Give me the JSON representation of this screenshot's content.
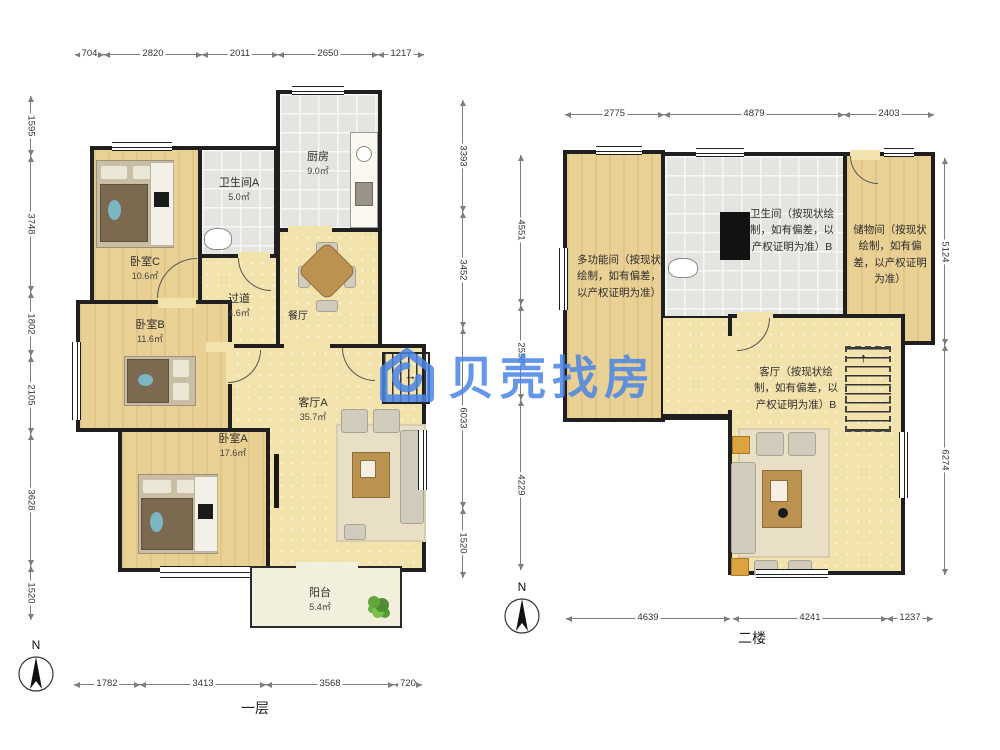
{
  "watermark": {
    "brand": "贝壳找房",
    "color": "#4a85e6"
  },
  "floor1": {
    "label": "一层",
    "compass": "N",
    "rooms": {
      "kitchen": {
        "name": "厨房",
        "area": "9.0㎡"
      },
      "bathA": {
        "name": "卫生间A",
        "area": "5.0㎡"
      },
      "bedC": {
        "name": "卧室C",
        "area": "10.6㎡"
      },
      "hall": {
        "name": "过道",
        "area": "4.6㎡"
      },
      "dining": {
        "name": "餐厅",
        "area": ""
      },
      "bedB": {
        "name": "卧室B",
        "area": "11.6㎡"
      },
      "livingA": {
        "name": "客厅A",
        "area": "35.7㎡"
      },
      "bedA": {
        "name": "卧室A",
        "area": "17.6㎡"
      },
      "balcony": {
        "name": "阳台",
        "area": "5.4㎡"
      }
    },
    "dims": {
      "top": [
        "704",
        "2820",
        "2011",
        "2650",
        "1217"
      ],
      "left": [
        "1595",
        "3748",
        "1802",
        "2105",
        "3628",
        "1520"
      ],
      "right": [
        "3393",
        "3452",
        "6033",
        "1520"
      ],
      "bottom": [
        "1782",
        "3413",
        "3568",
        "720"
      ]
    }
  },
  "floor2": {
    "label": "二楼",
    "compass": "N",
    "rooms": {
      "multi": {
        "name": "多功能间（按现状绘制，如有偏差，以产权证明为准）"
      },
      "bathB": {
        "name": "卫生间（按现状绘制，如有偏差，以产权证明为准）B"
      },
      "storage": {
        "name": "储物间（按现状绘制，如有偏差，以产权证明为准）"
      },
      "livingB": {
        "name": "客厅（按现状绘制，如有偏差，以产权证明为准）B"
      }
    },
    "dims": {
      "top": [
        "2775",
        "4879",
        "2403"
      ],
      "left": [
        "4551",
        "2558",
        "4229"
      ],
      "right": [
        "5124",
        "6274"
      ],
      "bottom": [
        "4639",
        "4241",
        "1237"
      ]
    }
  },
  "colors": {
    "wall": "#1f1f1f",
    "wood": "#e9d094",
    "tile": "#e4e4e1",
    "balcony": "#f2efdc"
  }
}
